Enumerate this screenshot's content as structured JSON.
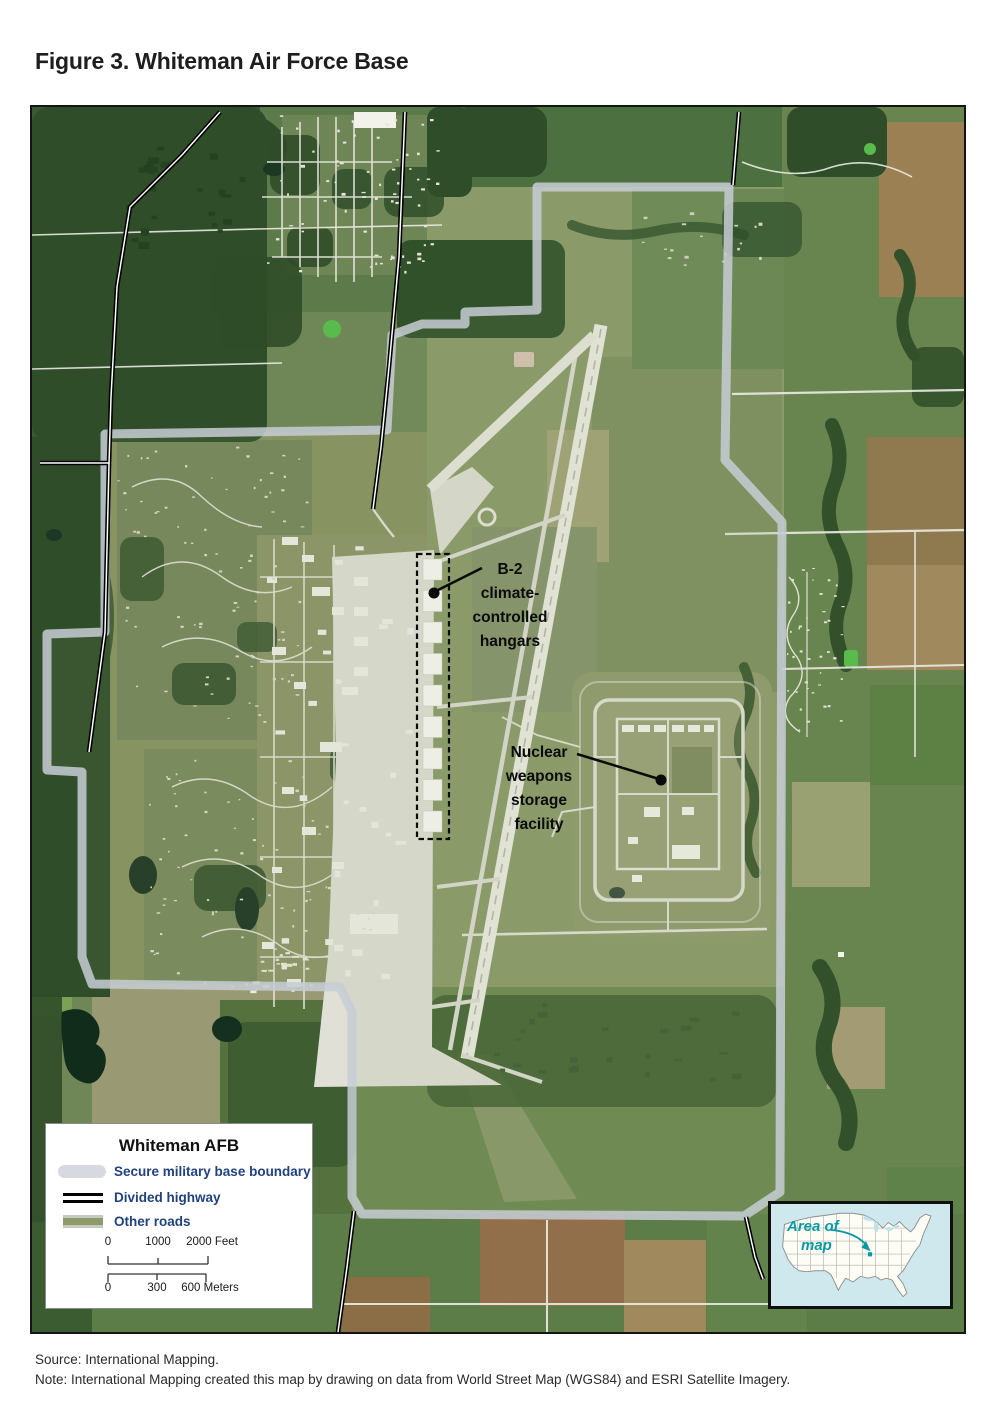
{
  "figure": {
    "title": "Figure 3. Whiteman Air Force Base"
  },
  "map": {
    "callouts": {
      "b2": {
        "lines": [
          "B-2",
          "climate-",
          "controlled",
          "hangars"
        ]
      },
      "nuclear": {
        "lines": [
          "Nuclear",
          "weapons",
          "storage",
          "facility"
        ]
      }
    },
    "legend": {
      "title": "Whiteman AFB",
      "items": [
        {
          "label": "Secure military base boundary"
        },
        {
          "label": "Divided highway"
        },
        {
          "label": "Other roads"
        }
      ],
      "scale_feet": {
        "t0": "0",
        "t1": "1000",
        "t2": "2000 Feet"
      },
      "scale_meters": {
        "t0": "0",
        "t1": "300",
        "t2": "600 Meters"
      }
    },
    "inset": {
      "line1": "Area of",
      "line2": "map"
    },
    "colors": {
      "boundary": "#c7ccd5",
      "divided_highway": "#000000",
      "other_roads": "#8f9a6a",
      "legend_text": "#21417f",
      "inset_accent": "#0a9aa4",
      "forest": "#2f4d28",
      "water": "#16301f",
      "concrete": "#e0e0d7"
    }
  },
  "footer": {
    "source": "Source: International Mapping.",
    "note": "Note: International Mapping created this map by drawing on data from World Street Map (WGS84) and ESRI Satellite Imagery."
  }
}
